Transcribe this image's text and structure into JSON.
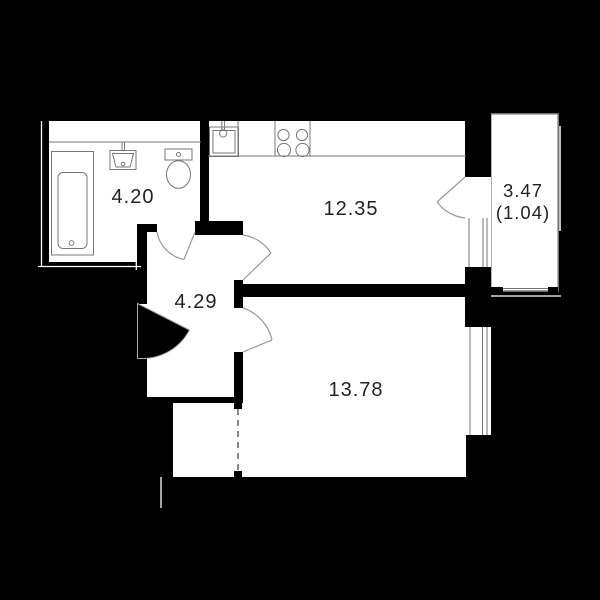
{
  "title": "apartment-floor-plan",
  "colors": {
    "background": "#000000",
    "floor": "#ffffff",
    "wall": "#000000",
    "detail_line": "#777777",
    "door_arc": "#999999",
    "outline": "#ffffff",
    "label": "#232323"
  },
  "rooms": {
    "bathroom": {
      "area": "4.20"
    },
    "kitchen": {
      "area": "12.35"
    },
    "hallway": {
      "area": "4.29"
    },
    "living_room": {
      "area": "13.78"
    },
    "balcony": {
      "area": "3.47",
      "reduced_area": "(1.04)"
    }
  }
}
